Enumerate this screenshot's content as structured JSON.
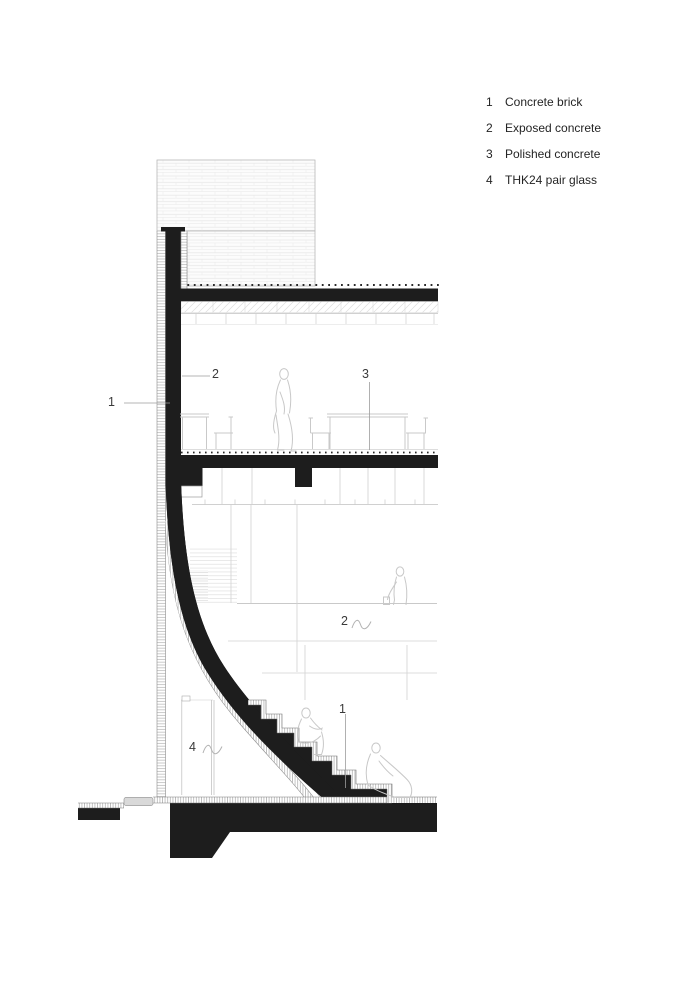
{
  "title": "Architectural cross-section drawing",
  "legend": {
    "items": [
      {
        "num": "1",
        "label": "Concrete brick"
      },
      {
        "num": "2",
        "label": "Exposed concrete"
      },
      {
        "num": "3",
        "label": "Polished concrete"
      },
      {
        "num": "4",
        "label": "THK24 pair glass"
      }
    ]
  },
  "callouts": [
    {
      "num": "1",
      "target": "curved-brick-facade-wall"
    },
    {
      "num": "2",
      "target": "exposed-concrete-wall-upper-floor"
    },
    {
      "num": "3",
      "target": "polished-concrete-floor"
    },
    {
      "num": "2",
      "target": "exposed-concrete-mezzanine"
    },
    {
      "num": "4",
      "target": "thk24-pair-glass-wall"
    },
    {
      "num": "1",
      "target": "concrete-brick-stair"
    }
  ],
  "colors": {
    "ink": "#1d1d1d",
    "light_line": "#cdcdcd",
    "label_text": "#3a3a3a",
    "legend_text": "#242424"
  }
}
